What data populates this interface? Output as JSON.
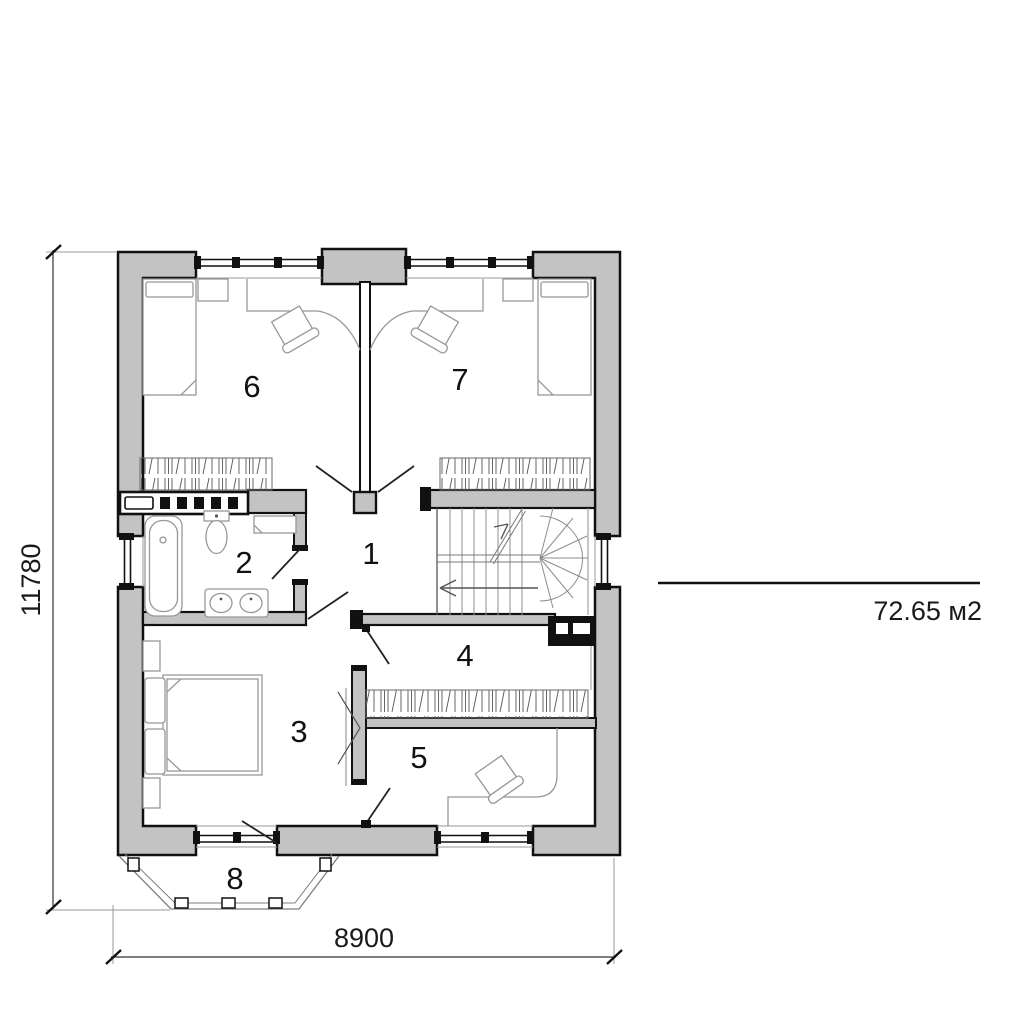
{
  "colors": {
    "wall_fill": "#c3c3c3",
    "outline": "#111111",
    "furniture_line": "#999999",
    "background": "#ffffff"
  },
  "rooms": [
    {
      "label": "1"
    },
    {
      "label": "2"
    },
    {
      "label": "3"
    },
    {
      "label": "4"
    },
    {
      "label": "5"
    },
    {
      "label": "6"
    },
    {
      "label": "7"
    },
    {
      "label": "8"
    }
  ],
  "dimensions": {
    "total_width": "8900",
    "total_height": "11780"
  },
  "area_note": {
    "value": "72.65 м2"
  }
}
